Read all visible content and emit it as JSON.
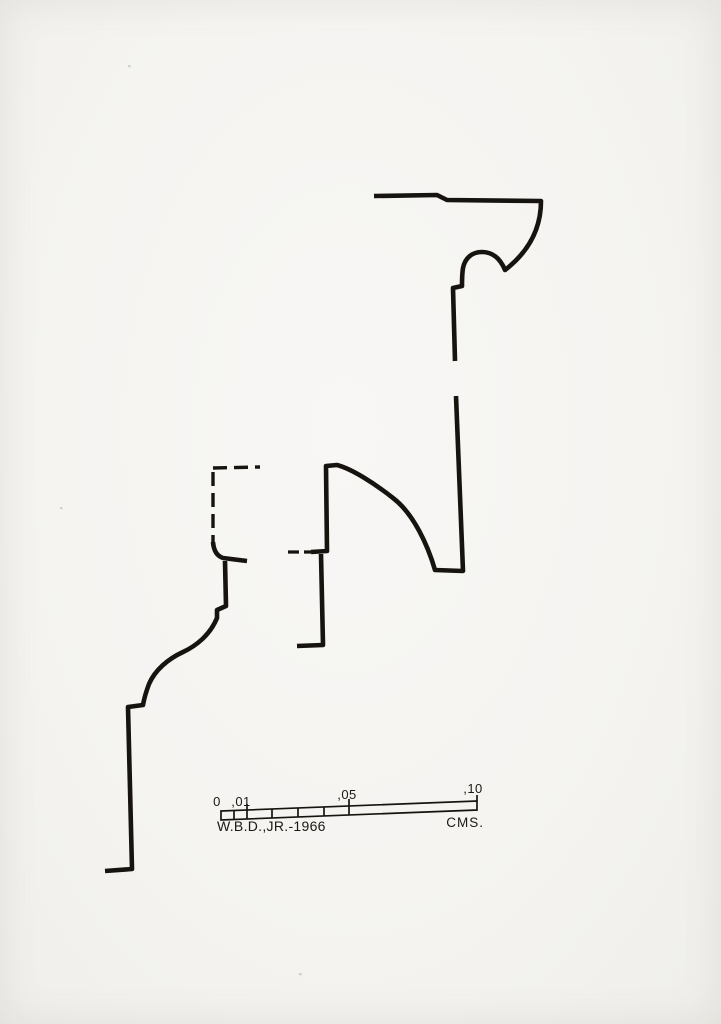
{
  "document": {
    "kind": "measured molding profile drawing",
    "background_color": "#f5f4f1",
    "ink_color": "#17140f"
  },
  "scale_bar": {
    "tick_labels": [
      "0",
      ",01",
      ",05",
      ",10"
    ],
    "unit_label": "CMS.",
    "credit": "W.B.D.,JR.-1966"
  },
  "drawing": {
    "paths": [
      {
        "name": "crown-profile",
        "style": "ink",
        "d": "M 374 196 L 437 195 L 447 200 L 541 201 C 541 231 527 253 505 270 C 500 258 492 252 482 252 C 472 252 465 258 463 268 C 462 274 462 280 462 286 L 453 288 L 455 361"
      },
      {
        "name": "mid-profile-right",
        "style": "ink",
        "d": "M 456 396 L 463 571 L 435 570 C 428 546 414 514 393 498 C 374 483 352 469 337 465 L 326 466 L 327 551 L 311 552"
      },
      {
        "name": "mid-profile-lower-leg",
        "style": "ink",
        "d": "M 321 554 L 323 645 L 297 646"
      },
      {
        "name": "left-block-top-dashed",
        "style": "ink-dashed",
        "d": "M 213 468 L 260 467"
      },
      {
        "name": "left-block-side-dashed",
        "style": "ink-dashed",
        "d": "M 213 472 L 213 546"
      },
      {
        "name": "left-block-foot",
        "style": "ink",
        "d": "M 213 542 Q 214 555 223 558 L 247 561"
      },
      {
        "name": "mid-profile-dashed-link",
        "style": "ink-dashed-short",
        "d": "M 288 552 L 311 552"
      },
      {
        "name": "base-profile",
        "style": "ink",
        "d": "M 225 561 L 226 606 L 217 610 L 217 618 C 210 635 196 646 183 652 C 168 659 155 670 149 684 C 146 692 144 699 143 705 L 128 707 L 132 869 L 105 871"
      },
      {
        "name": "scale-bar-outline",
        "style": "ink-thin",
        "d": "M 221 811 L 477 801 L 477 810 L 221 820 Z"
      },
      {
        "name": "scale-bar-ticks",
        "style": "ink-thin",
        "d": "M 234 810.5 L 234 819.5 M 247 804 L 247 819 M 272 809 L 272 818 M 298 808 L 298 817 M 324 807 L 324 816 M 349 799 L 349 815 M 477 795 L 477 801"
      },
      {
        "name": "paper-specks",
        "style": "ink-speck",
        "d": "M 129 66 L 129.6 66.3 M 61 508 L 61.6 508.3 M 300 974 L 300.6 974.3"
      }
    ]
  }
}
